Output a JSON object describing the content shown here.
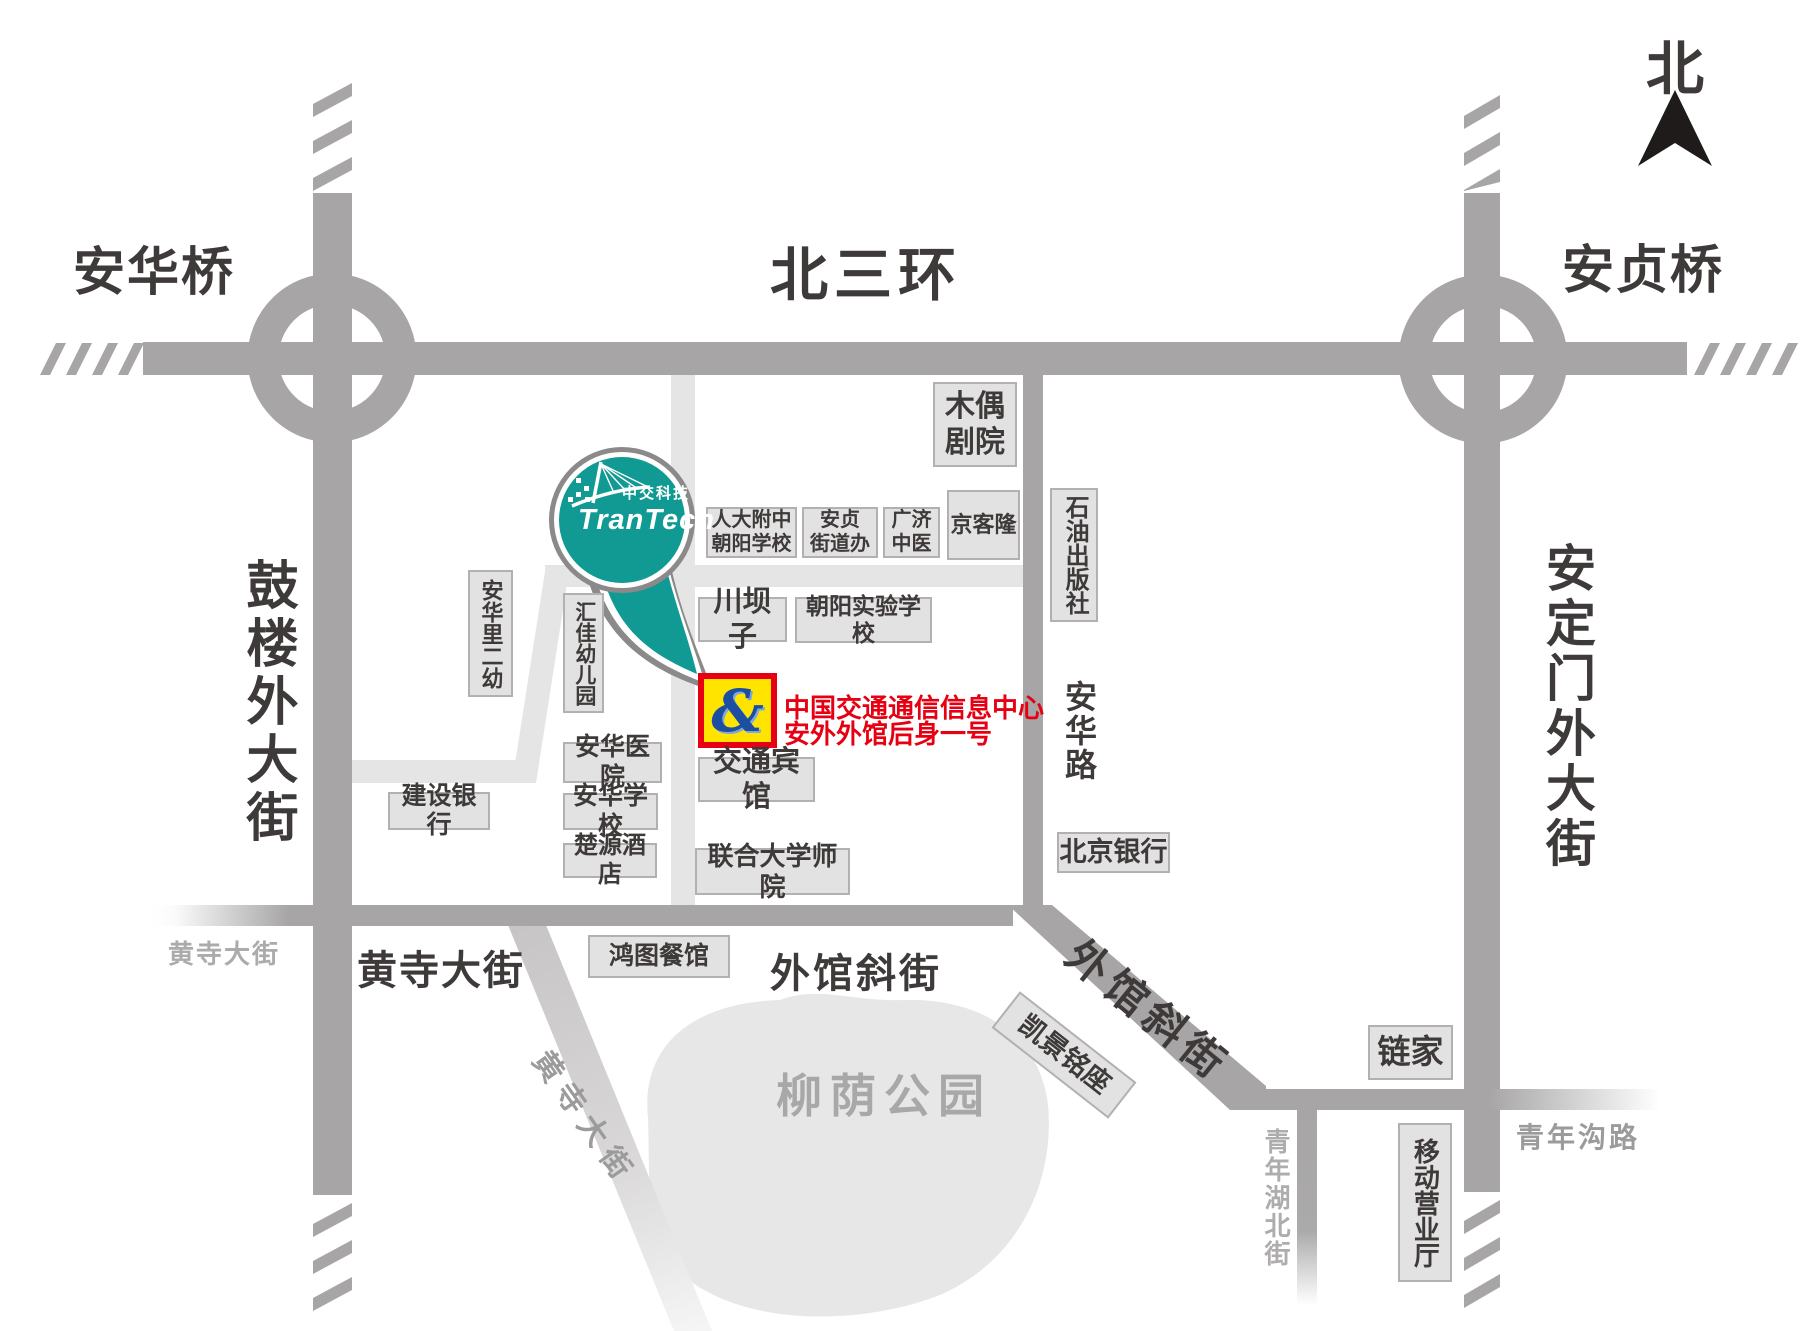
{
  "compass": {
    "north_label": "北"
  },
  "roads": {
    "bei_san_huan": "北三环",
    "anhua_qiao": "安华桥",
    "anzhen_qiao": "安贞桥",
    "gulou_outer_st": "鼓楼外大街",
    "andingmen_outer_st": "安定门外大街",
    "anhua_rd": "安华路",
    "huangsi_st_dark": "黄寺大街",
    "huangsi_st_gray": "黄寺大街",
    "huangsi_st_diagonal": "黄寺大街",
    "waiguan_xiejie_dark": "外馆斜街",
    "waiguan_xiejie_diagonal": "外馆斜街",
    "qingniangou_rd": "青年沟路",
    "qingnianhubei_st": "青年湖北街"
  },
  "park": {
    "name": "柳荫公园"
  },
  "places": {
    "muou_theater": "木偶\n剧院",
    "renda_school": "人大附中\n朝阳学校",
    "anzhen_office": "安贞\n街道办",
    "guangji_clinic": "广济\n中医",
    "jingkelong": "京客隆",
    "shiyou_press": "石油出版社",
    "chuanbazi": "川坝子",
    "chaoyang_school": "朝阳实验学校",
    "anhuali_kindergarten": "安华里二幼",
    "huijia_kindergarten": "汇佳幼儿园",
    "anhua_hospital": "安华医院",
    "jianshe_bank": "建设银行",
    "anhua_school": "安华学校",
    "chuyuan_hotel": "楚源酒店",
    "jiaotong_hotel": "交通宾馆",
    "lianhe_university": "联合大学师院",
    "hongtu_restaurant": "鸿图餐馆",
    "beijing_bank": "北京银行",
    "kaijing_mingzuo": "凯景铭座",
    "lianjia": "链家",
    "yidong_office": "移动营业厅"
  },
  "marker": {
    "line1": "中国交通通信信息中心",
    "line2": "安外外馆后身一号",
    "logo_glyph": "&"
  },
  "brand": {
    "cn": "中交科技",
    "en": "TranTech"
  },
  "colors": {
    "road_gray": "#a7a5a6",
    "light_road_gray": "#e6e5e5",
    "balloon_teal": "#119a93",
    "marker_yellow": "#ffe400",
    "marker_red": "#e60012",
    "dark_text": "#3f3a3a"
  }
}
